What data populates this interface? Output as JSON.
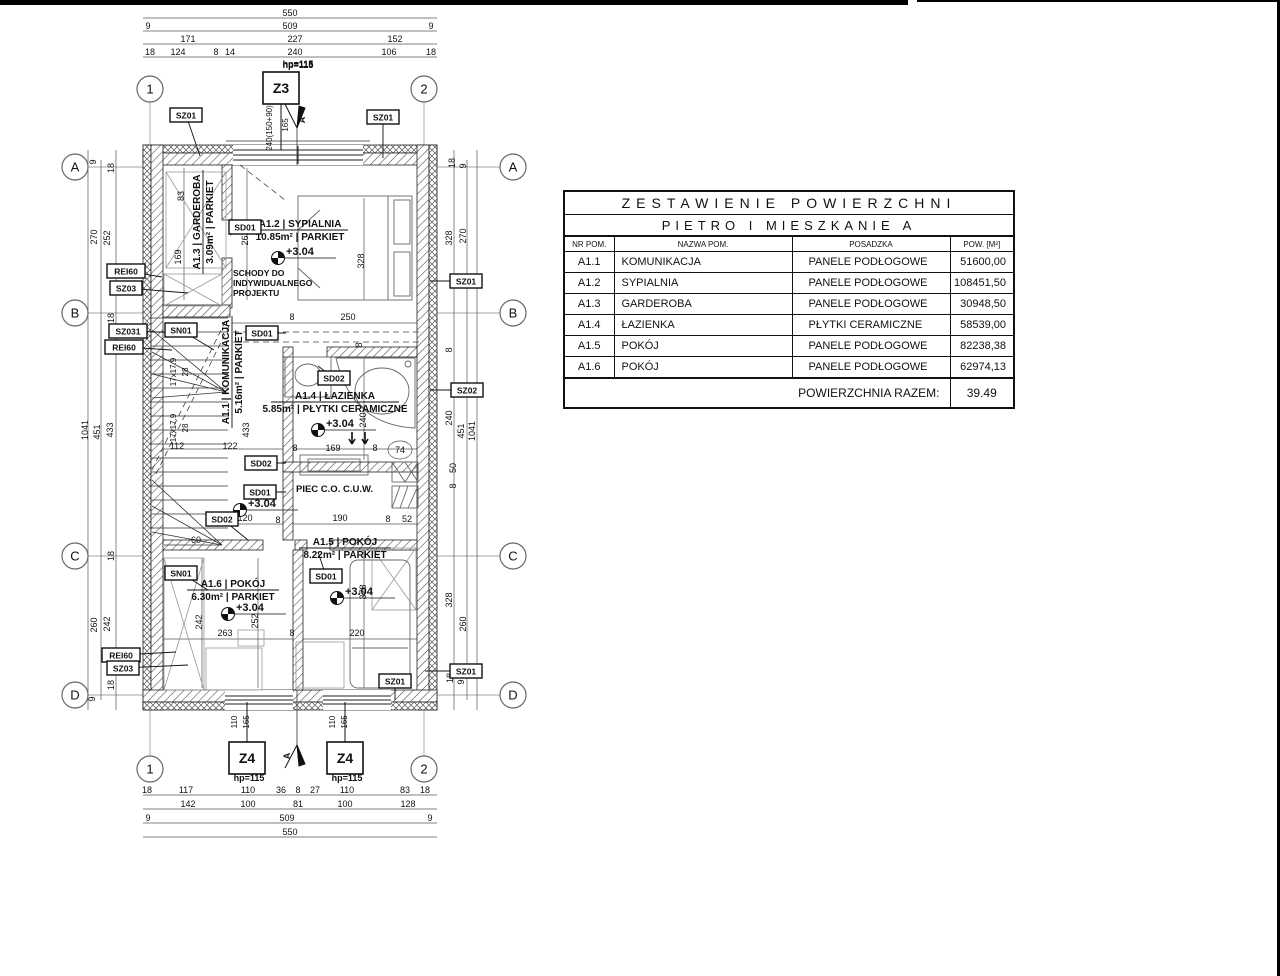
{
  "sheet": {
    "bar1_w": 908,
    "bar2_x": 917,
    "bar2_w": 363,
    "line_color": "#111111",
    "bg": "#ffffff"
  },
  "table": {
    "title1": "ZESTAWIENIE POWIERZCHNI",
    "title2": "PIETRO I MIESZKANIE A",
    "columns": [
      "NR POM.",
      "NAZWA POM.",
      "POSADZKA",
      "POW. [M²]"
    ],
    "rows": [
      [
        "A1.1",
        "KOMUNIKACJA",
        "PANELE PODŁOGOWE",
        "51600,00"
      ],
      [
        "A1.2",
        "SYPIALNIA",
        "PANELE PODŁOGOWE",
        "108451,50"
      ],
      [
        "A1.3",
        "GARDEROBA",
        "PANELE PODŁOGOWE",
        "30948,50"
      ],
      [
        "A1.4",
        "ŁAZIENKA",
        "PŁYTKI CERAMICZNE",
        "58539,00"
      ],
      [
        "A1.5",
        "POKÓJ",
        "PANELE PODŁOGOWE",
        "82238,38"
      ],
      [
        "A1.6",
        "POKÓJ",
        "PANELE PODŁOGOWE",
        "62974,13"
      ]
    ],
    "footer_label": "POWIERZCHNIA RAZEM:",
    "footer_value": "39.49"
  },
  "plan": {
    "texts": {
      "piec": "PIEC C.O. C.U.W.",
      "schody1": "SCHODY DO",
      "schody2": "INDYWIDUALNEGO",
      "schody3": "PROJEKTU",
      "section_mark": "A"
    },
    "room_labels": [
      {
        "num": "A1.2",
        "name": "SYPIALNIA",
        "area": "10.85m²",
        "floor": "PARKIET",
        "x": 300,
        "y": 230,
        "rot": 0,
        "w": 96
      },
      {
        "num": "A1.3",
        "name": "GARDEROBA",
        "area": "3.09m²",
        "floor": "PARKIET",
        "x": 203,
        "y": 222,
        "rot": -90,
        "w": 104
      },
      {
        "num": "A1.1",
        "name": "KOMUNIKACJA",
        "area": "5.16m²",
        "floor": "PARKIET",
        "x": 232,
        "y": 372,
        "rot": -90,
        "w": 112
      },
      {
        "num": "A1.4",
        "name": "ŁAZIENKA",
        "area": "5.85m²",
        "floor": "PŁYTKI CERAMICZNE",
        "x": 335,
        "y": 402,
        "rot": 0,
        "w": 128
      },
      {
        "num": "A1.5",
        "name": "POKÓJ",
        "area": "8.22m²",
        "floor": "PARKIET",
        "x": 345,
        "y": 548,
        "rot": 0,
        "w": 92
      },
      {
        "num": "A1.6",
        "name": "POKÓJ",
        "area": "6.30m²",
        "floor": "PARKIET",
        "x": 233,
        "y": 590,
        "rot": 0,
        "w": 92
      }
    ],
    "level_markers": [
      {
        "label": "+3.04",
        "x": 278,
        "y": 258
      },
      {
        "label": "+3.04",
        "x": 318,
        "y": 430
      },
      {
        "label": "+3.04",
        "x": 240,
        "y": 510
      },
      {
        "label": "+3.04",
        "x": 228,
        "y": 614
      },
      {
        "label": "+3.04",
        "x": 337,
        "y": 598
      }
    ],
    "grid_bubbles": [
      {
        "t": "1",
        "x": 150,
        "y": 89
      },
      {
        "t": "2",
        "x": 424,
        "y": 89
      },
      {
        "t": "1",
        "x": 150,
        "y": 769
      },
      {
        "t": "2",
        "x": 424,
        "y": 769
      },
      {
        "t": "A",
        "x": 75,
        "y": 167
      },
      {
        "t": "B",
        "x": 75,
        "y": 313
      },
      {
        "t": "C",
        "x": 75,
        "y": 556
      },
      {
        "t": "D",
        "x": 75,
        "y": 695
      },
      {
        "t": "A",
        "x": 513,
        "y": 167
      },
      {
        "t": "B",
        "x": 513,
        "y": 313
      },
      {
        "t": "C",
        "x": 513,
        "y": 556
      },
      {
        "t": "D",
        "x": 513,
        "y": 695
      }
    ],
    "window_tags": [
      {
        "t": "Z3",
        "x": 281,
        "y": 88,
        "lx": 281,
        "ly": 150,
        "hp": "hp=115",
        "hx": 298,
        "hy": 68
      },
      {
        "t": "Z4",
        "x": 247,
        "y": 758,
        "lx": 247,
        "ly": 702,
        "hp": "hp=115",
        "hx": 249,
        "hy": 781
      },
      {
        "t": "Z4",
        "x": 345,
        "y": 758,
        "lx": 345,
        "ly": 702,
        "hp": "hp=115",
        "hx": 347,
        "hy": 781
      }
    ],
    "tag_boxes": [
      {
        "t": "SZ01",
        "x": 186,
        "y": 115,
        "lx": 200,
        "ly": 156
      },
      {
        "t": "SZ01",
        "x": 383,
        "y": 117,
        "lx": 383,
        "ly": 158
      },
      {
        "t": "SZ01",
        "x": 466,
        "y": 281,
        "lx": 430,
        "ly": 281
      },
      {
        "t": "SZ02",
        "x": 467,
        "y": 390,
        "lx": 430,
        "ly": 390
      },
      {
        "t": "SZ01",
        "x": 466,
        "y": 671,
        "lx": 425,
        "ly": 671
      },
      {
        "t": "SZ01",
        "x": 395,
        "y": 681,
        "lx": 395,
        "ly": 700
      },
      {
        "t": "REI60",
        "x": 126,
        "y": 271,
        "lx": 162,
        "ly": 277
      },
      {
        "t": "SZ03",
        "x": 126,
        "y": 288,
        "lx": 188,
        "ly": 293
      },
      {
        "t": "SZ031",
        "x": 128,
        "y": 331,
        "lx": 188,
        "ly": 333
      },
      {
        "t": "REI60",
        "x": 124,
        "y": 347,
        "lx": 172,
        "ly": 350
      },
      {
        "t": "SN01",
        "x": 181,
        "y": 330,
        "lx": 214,
        "ly": 350
      },
      {
        "t": "SN01",
        "x": 181,
        "y": 573,
        "lx": 208,
        "ly": 590
      },
      {
        "t": "REI60",
        "x": 121,
        "y": 655,
        "lx": 176,
        "ly": 652
      },
      {
        "t": "SZ03",
        "x": 123,
        "y": 668,
        "lx": 188,
        "ly": 665
      },
      {
        "t": "SD01",
        "x": 245,
        "y": 227,
        "lx": 230,
        "ly": 235
      },
      {
        "t": "SD01",
        "x": 262,
        "y": 333,
        "lx": 286,
        "ly": 333
      },
      {
        "t": "SD02",
        "x": 334,
        "y": 378,
        "lx": 318,
        "ly": 366
      },
      {
        "t": "SD02",
        "x": 261,
        "y": 463,
        "lx": 286,
        "ly": 463
      },
      {
        "t": "SD01",
        "x": 260,
        "y": 492,
        "lx": 286,
        "ly": 492
      },
      {
        "t": "SD02",
        "x": 222,
        "y": 519,
        "lx": 248,
        "ly": 540
      },
      {
        "t": "SD01",
        "x": 326,
        "y": 576,
        "lx": 318,
        "ly": 552
      }
    ],
    "dim_labels": [
      {
        "t": "550",
        "x": 290,
        "y": 16
      },
      {
        "t": "9",
        "x": 148,
        "y": 29
      },
      {
        "t": "509",
        "x": 290,
        "y": 29
      },
      {
        "t": "9",
        "x": 431,
        "y": 29
      },
      {
        "t": "171",
        "x": 188,
        "y": 42
      },
      {
        "t": "227",
        "x": 295,
        "y": 42
      },
      {
        "t": "152",
        "x": 395,
        "y": 42
      },
      {
        "t": "18",
        "x": 150,
        "y": 55
      },
      {
        "t": "124",
        "x": 178,
        "y": 55
      },
      {
        "t": "8",
        "x": 216,
        "y": 55
      },
      {
        "t": "14",
        "x": 230,
        "y": 55
      },
      {
        "t": "240",
        "x": 295,
        "y": 55
      },
      {
        "t": "106",
        "x": 389,
        "y": 55
      },
      {
        "t": "18",
        "x": 431,
        "y": 55
      },
      {
        "t": "hp=115",
        "x": 298,
        "y": 67,
        "b": 1
      },
      {
        "t": "240(150+90)",
        "x": 272,
        "y": 128,
        "r": 1,
        "s": 8
      },
      {
        "t": "165",
        "x": 288,
        "y": 125,
        "r": 1,
        "s": 8
      },
      {
        "t": "18",
        "x": 147,
        "y": 793
      },
      {
        "t": "117",
        "x": 186,
        "y": 793
      },
      {
        "t": "110",
        "x": 248,
        "y": 793
      },
      {
        "t": "36",
        "x": 281,
        "y": 793
      },
      {
        "t": "8",
        "x": 298,
        "y": 793
      },
      {
        "t": "27",
        "x": 315,
        "y": 793
      },
      {
        "t": "110",
        "x": 347,
        "y": 793
      },
      {
        "t": "83",
        "x": 405,
        "y": 793
      },
      {
        "t": "18",
        "x": 425,
        "y": 793
      },
      {
        "t": "142",
        "x": 188,
        "y": 807
      },
      {
        "t": "100",
        "x": 248,
        "y": 807
      },
      {
        "t": "81",
        "x": 298,
        "y": 807
      },
      {
        "t": "100",
        "x": 345,
        "y": 807
      },
      {
        "t": "128",
        "x": 408,
        "y": 807
      },
      {
        "t": "9",
        "x": 148,
        "y": 821
      },
      {
        "t": "509",
        "x": 287,
        "y": 821
      },
      {
        "t": "9",
        "x": 430,
        "y": 821
      },
      {
        "t": "550",
        "x": 290,
        "y": 835
      },
      {
        "t": "9",
        "x": 96,
        "y": 162,
        "r": 1
      },
      {
        "t": "18",
        "x": 114,
        "y": 168,
        "r": 1
      },
      {
        "t": "270",
        "x": 97,
        "y": 237,
        "r": 1
      },
      {
        "t": "252",
        "x": 110,
        "y": 238,
        "r": 1
      },
      {
        "t": "18",
        "x": 114,
        "y": 318,
        "r": 1
      },
      {
        "t": "1041",
        "x": 88,
        "y": 430,
        "r": 1
      },
      {
        "t": "451",
        "x": 100,
        "y": 432,
        "r": 1
      },
      {
        "t": "433",
        "x": 113,
        "y": 430,
        "r": 1
      },
      {
        "t": "18",
        "x": 114,
        "y": 556,
        "r": 1
      },
      {
        "t": "260",
        "x": 97,
        "y": 625,
        "r": 1
      },
      {
        "t": "242",
        "x": 110,
        "y": 624,
        "r": 1
      },
      {
        "t": "18",
        "x": 114,
        "y": 685,
        "r": 1
      },
      {
        "t": "9",
        "x": 95,
        "y": 699,
        "r": 1
      },
      {
        "t": "18",
        "x": 455,
        "y": 163,
        "r": 1
      },
      {
        "t": "9",
        "x": 466,
        "y": 166,
        "r": 1
      },
      {
        "t": "328",
        "x": 452,
        "y": 238,
        "r": 1
      },
      {
        "t": "270",
        "x": 466,
        "y": 236,
        "r": 1
      },
      {
        "t": "8",
        "x": 452,
        "y": 350,
        "r": 1
      },
      {
        "t": "240",
        "x": 452,
        "y": 418,
        "r": 1
      },
      {
        "t": "451",
        "x": 464,
        "y": 431,
        "r": 1
      },
      {
        "t": "1041",
        "x": 475,
        "y": 431,
        "r": 1
      },
      {
        "t": "50",
        "x": 456,
        "y": 468,
        "r": 1
      },
      {
        "t": "8",
        "x": 456,
        "y": 486,
        "r": 1
      },
      {
        "t": "328",
        "x": 452,
        "y": 600,
        "r": 1
      },
      {
        "t": "260",
        "x": 466,
        "y": 624,
        "r": 1
      },
      {
        "t": "18",
        "x": 453,
        "y": 678,
        "r": 1
      },
      {
        "t": "9",
        "x": 464,
        "y": 682,
        "r": 1
      },
      {
        "t": "83",
        "x": 184,
        "y": 196,
        "r": 1
      },
      {
        "t": "169",
        "x": 181,
        "y": 257,
        "r": 1
      },
      {
        "t": "262",
        "x": 248,
        "y": 238,
        "r": 1
      },
      {
        "t": "328",
        "x": 364,
        "y": 261,
        "r": 1
      },
      {
        "t": "8",
        "x": 292,
        "y": 320
      },
      {
        "t": "250",
        "x": 348,
        "y": 320
      },
      {
        "t": "17x17.9",
        "x": 176,
        "y": 372,
        "r": 1,
        "s": 8
      },
      {
        "t": "28",
        "x": 188,
        "y": 372,
        "r": 1,
        "s": 8
      },
      {
        "t": "17x17.9",
        "x": 176,
        "y": 428,
        "r": 1,
        "s": 8
      },
      {
        "t": "28",
        "x": 188,
        "y": 428,
        "r": 1,
        "s": 8
      },
      {
        "t": "8",
        "x": 362,
        "y": 345,
        "r": 1
      },
      {
        "t": "240",
        "x": 366,
        "y": 420,
        "r": 1
      },
      {
        "t": "112",
        "x": 177,
        "y": 449
      },
      {
        "t": "122",
        "x": 230,
        "y": 449
      },
      {
        "t": "433",
        "x": 249,
        "y": 430,
        "r": 1
      },
      {
        "t": "8",
        "x": 295,
        "y": 451
      },
      {
        "t": "169",
        "x": 333,
        "y": 451
      },
      {
        "t": "8",
        "x": 375,
        "y": 451
      },
      {
        "t": "74",
        "x": 400,
        "y": 453
      },
      {
        "t": "120",
        "x": 245,
        "y": 521
      },
      {
        "t": "8",
        "x": 278,
        "y": 523
      },
      {
        "t": "190",
        "x": 340,
        "y": 521
      },
      {
        "t": "8",
        "x": 388,
        "y": 522
      },
      {
        "t": "52",
        "x": 407,
        "y": 522
      },
      {
        "t": "60",
        "x": 196,
        "y": 543
      },
      {
        "t": "378",
        "x": 366,
        "y": 592,
        "r": 1
      },
      {
        "t": "242",
        "x": 202,
        "y": 622,
        "r": 1
      },
      {
        "t": "252",
        "x": 258,
        "y": 621,
        "r": 1
      },
      {
        "t": "263",
        "x": 225,
        "y": 636
      },
      {
        "t": "8",
        "x": 292,
        "y": 636
      },
      {
        "t": "220",
        "x": 357,
        "y": 636
      },
      {
        "t": "110",
        "x": 237,
        "y": 722,
        "r": 1,
        "s": 8
      },
      {
        "t": "165",
        "x": 249,
        "y": 722,
        "r": 1,
        "s": 8
      },
      {
        "t": "110",
        "x": 335,
        "y": 722,
        "r": 1,
        "s": 8
      },
      {
        "t": "165",
        "x": 347,
        "y": 722,
        "r": 1,
        "s": 8
      }
    ]
  }
}
